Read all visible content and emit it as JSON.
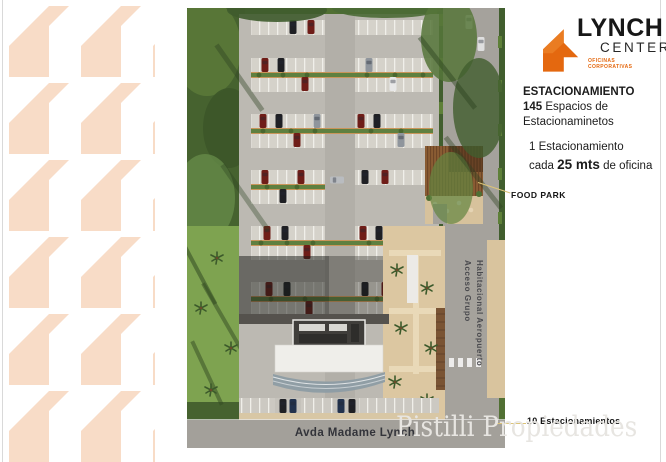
{
  "brand": {
    "name": "LYNCH",
    "sub": "CENTER",
    "tagline_line1": "OFICINAS",
    "tagline_line2": "CORPORATIVAS",
    "orange": "#e4680f"
  },
  "info": {
    "title": "ESTACIONAMIENTO",
    "count": "145",
    "count_rest": " Espacios de",
    "count_line2": "Estacionaminetos",
    "note_line1": "1 Estacionamiento",
    "note_pre": "cada ",
    "note_strong": "25 mts",
    "note_post": " de oficina"
  },
  "callouts": {
    "food_park": "FOOD PARK",
    "ten_spots": "10 Estacionamientos"
  },
  "map_labels": {
    "avenue": "Avda Madame Lynch",
    "access_line1": "Acceso Grupo",
    "access_line2": "Habitacional Aeropuerto"
  },
  "watermark": "Pistilli Propiedades",
  "colors": {
    "pattern_peach": "#f8dcc7",
    "brand_orange": "#e4680f",
    "edge_gray": "#d9d9d9",
    "road_gray": "#a3a09a",
    "lot_gray": "#bcb9b2",
    "sand": "#dcc7a1",
    "green_dark": "#415e2e",
    "green_lawn": "#7ea350",
    "leader_tan": "#dcc377"
  }
}
